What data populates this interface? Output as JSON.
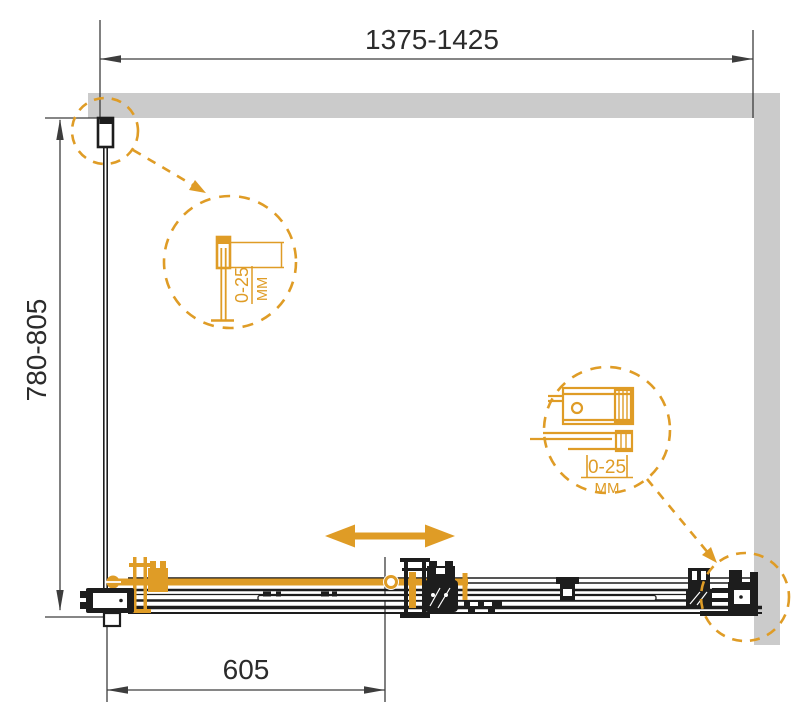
{
  "title": "shower-enclosure-installation-diagram",
  "colors": {
    "accent": "#DF9C26",
    "wall_fill": "#CBCBCB",
    "line": "#1D1D1D",
    "dim_line": "#3D3D3D",
    "text": "#2B2B2B",
    "background": "#FFFFFF"
  },
  "dimensions": {
    "overall_width": "1375-1425",
    "overall_depth": "780-805",
    "door_width": "605"
  },
  "detail_callouts": {
    "wall_profile": {
      "range": "0-25",
      "unit": "MM"
    },
    "wall_bracket": {
      "range": "0-25",
      "unit": "MM"
    }
  },
  "icons": {
    "slide_direction_icon": "double-headed-horizontal-arrow",
    "callout_circle_icon": "dashed-magnifier-circle"
  }
}
